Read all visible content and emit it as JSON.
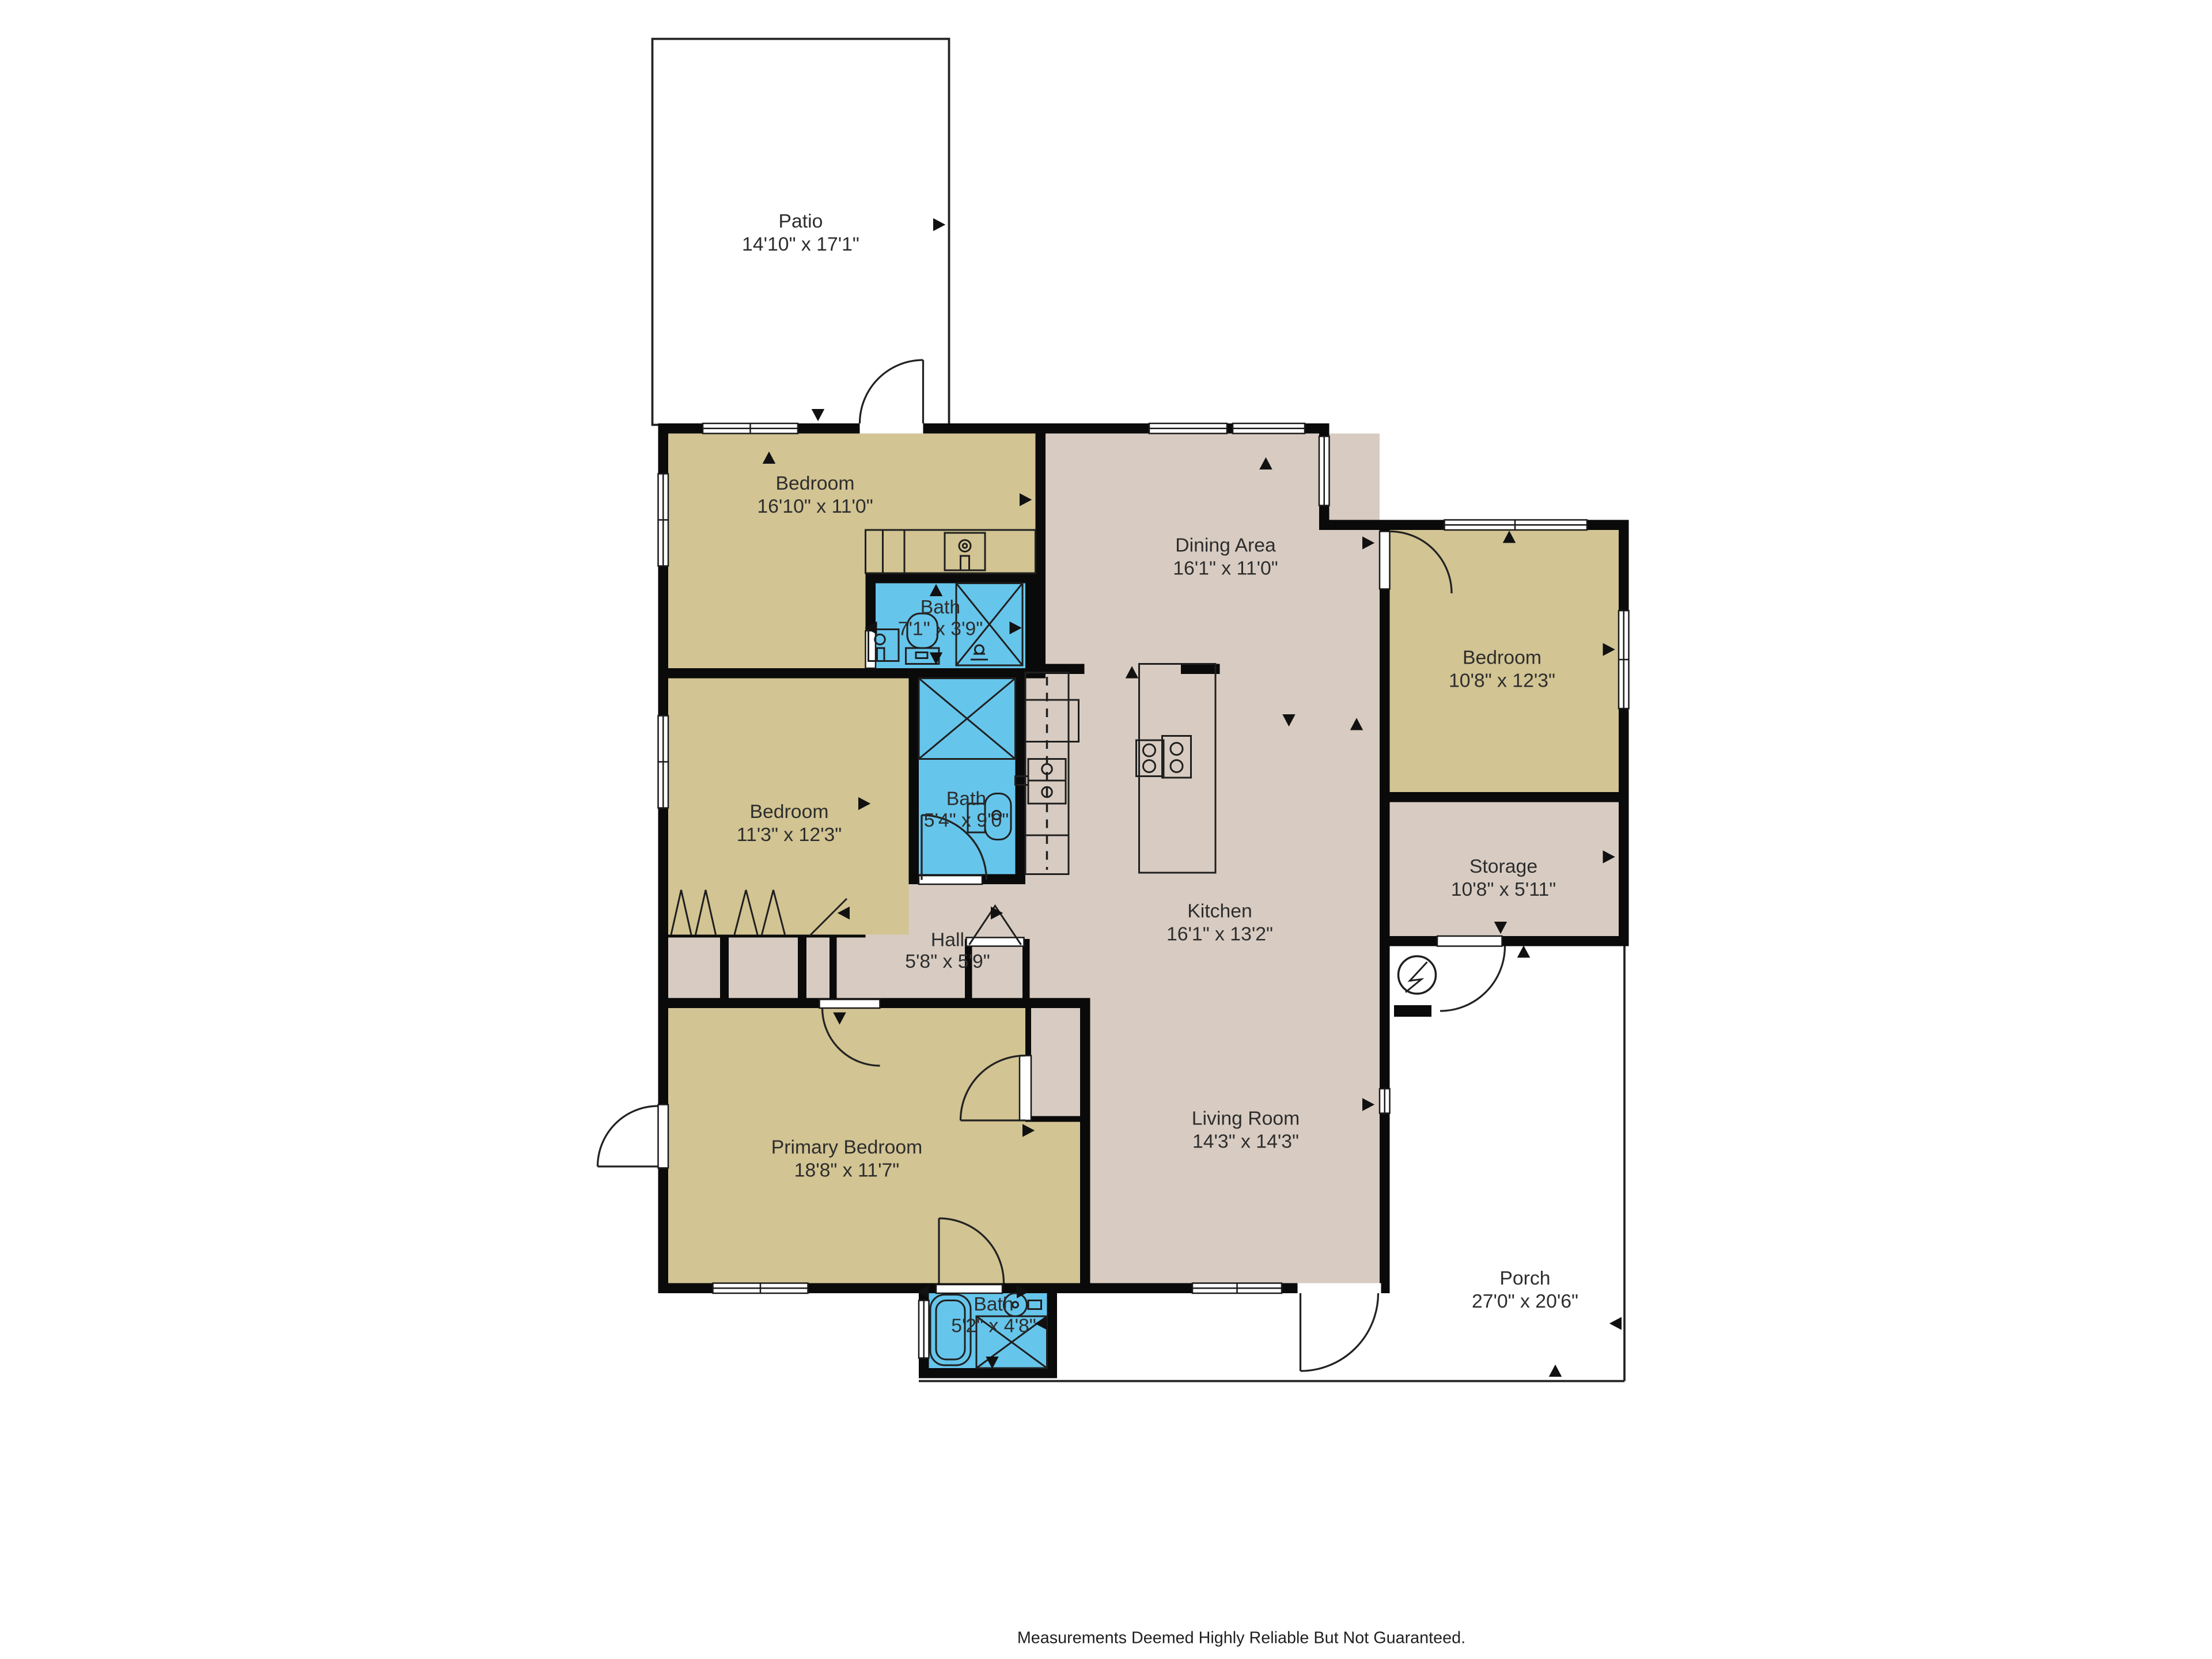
{
  "meta": {
    "type": "floor-plan",
    "colors": {
      "bedroom_fill": "#d2c493",
      "living_fill": "#d8ccc2",
      "bath_fill": "#66c5eb",
      "wall": "#0a0a0a",
      "outdoor_fill": "#ffffff",
      "label_text": "#2d2d2d"
    },
    "icons": {
      "electric_meter": "circle-with-lightning-bolt",
      "stove": "four-burner-cooktop",
      "shower": "x-crossed-box",
      "sink": "square-with-faucet-circle",
      "toilet": "bowl-with-tank",
      "bathtub": "rounded-tub"
    }
  },
  "rooms": {
    "patio": {
      "name": "Patio",
      "dims": "14'10\" x 17'1\""
    },
    "bedroom_top": {
      "name": "Bedroom",
      "dims": "16'10\" x 11'0\""
    },
    "bath_top": {
      "name": "Bath",
      "dims": "7'1\" x 3'9\""
    },
    "dining": {
      "name": "Dining Area",
      "dims": "16'1\" x 11'0\""
    },
    "bedroom_right": {
      "name": "Bedroom",
      "dims": "10'8\" x 12'3\""
    },
    "bedroom_mid": {
      "name": "Bedroom",
      "dims": "11'3\" x 12'3\""
    },
    "bath_mid": {
      "name": "Bath",
      "dims": "5'4\" x 9'0\""
    },
    "storage": {
      "name": "Storage",
      "dims": "10'8\" x 5'11\""
    },
    "hall": {
      "name": "Hall",
      "dims": "5'8\" x 5'9\""
    },
    "kitchen": {
      "name": "Kitchen",
      "dims": "16'1\" x 13'2\""
    },
    "primary": {
      "name": "Primary Bedroom",
      "dims": "18'8\" x 11'7\""
    },
    "living": {
      "name": "Living Room",
      "dims": "14'3\" x 14'3\""
    },
    "bath_bottom": {
      "name": "Bath",
      "dims": "5'2\" x 4'8\""
    },
    "porch": {
      "name": "Porch",
      "dims": "27'0\" x 20'6\""
    }
  },
  "footer": {
    "disclaimer": "Measurements Deemed Highly Reliable But Not Guaranteed."
  }
}
